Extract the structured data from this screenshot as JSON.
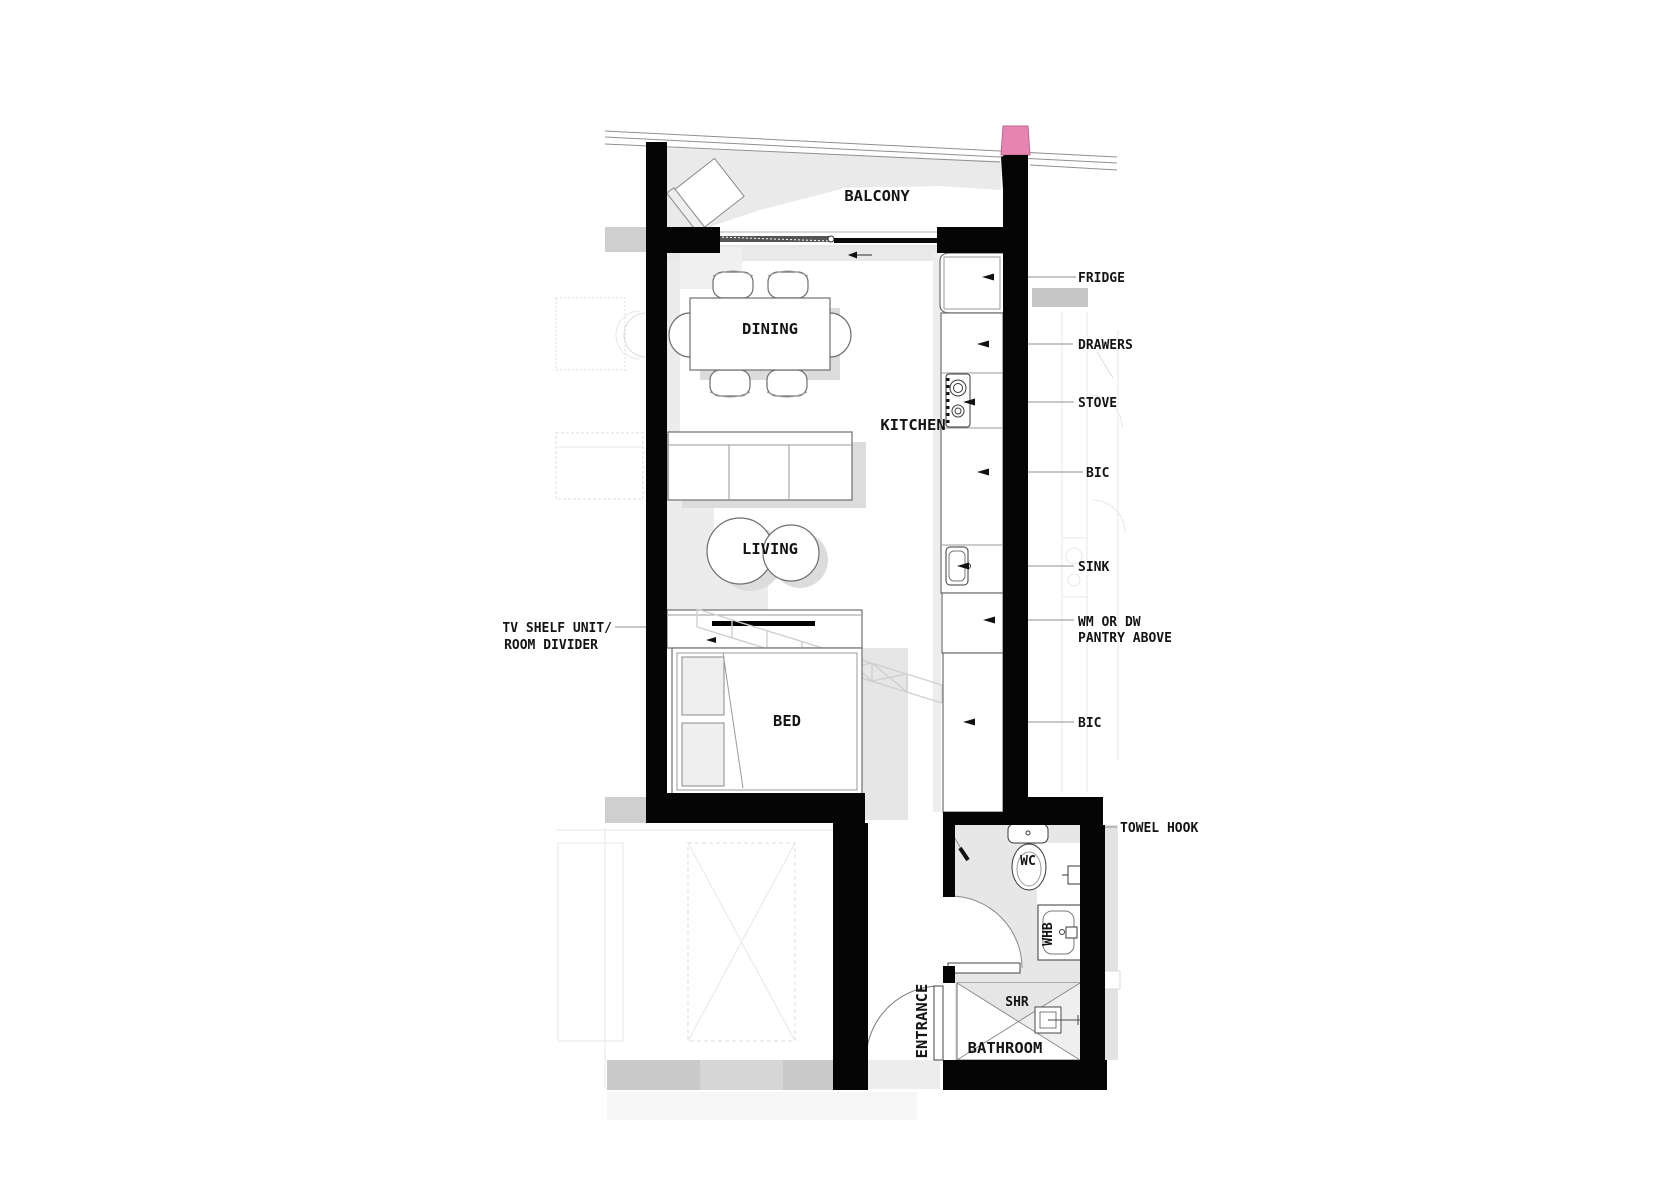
{
  "plan": {
    "title": "studio-apartment-floor-plan",
    "rooms": {
      "balcony": "BALCONY",
      "dining": "DINING",
      "kitchen": "KITCHEN",
      "living": "LIVING",
      "bed": "BED",
      "bathroom": "BATHROOM",
      "entrance": "ENTRANCE"
    },
    "callouts": {
      "fridge": "FRIDGE",
      "drawers": "DRAWERS",
      "stove": "STOVE",
      "bic_upper": "BIC",
      "sink": "SINK",
      "wm_line1": "WM OR DW",
      "wm_line2": "PANTRY ABOVE",
      "bic_lower": "BIC",
      "towel_hook": "TOWEL HOOK",
      "tv_line1": "TV SHELF UNIT/",
      "tv_line2": "ROOM DIVIDER"
    },
    "fixtures": {
      "wc": "WC",
      "whb": "WHB",
      "shr": "SHR"
    },
    "colors": {
      "wall": "#050505",
      "highlight_pink": "#e884b2",
      "shadow": "#dcdcdc",
      "floor_shade": "#ececec"
    }
  }
}
